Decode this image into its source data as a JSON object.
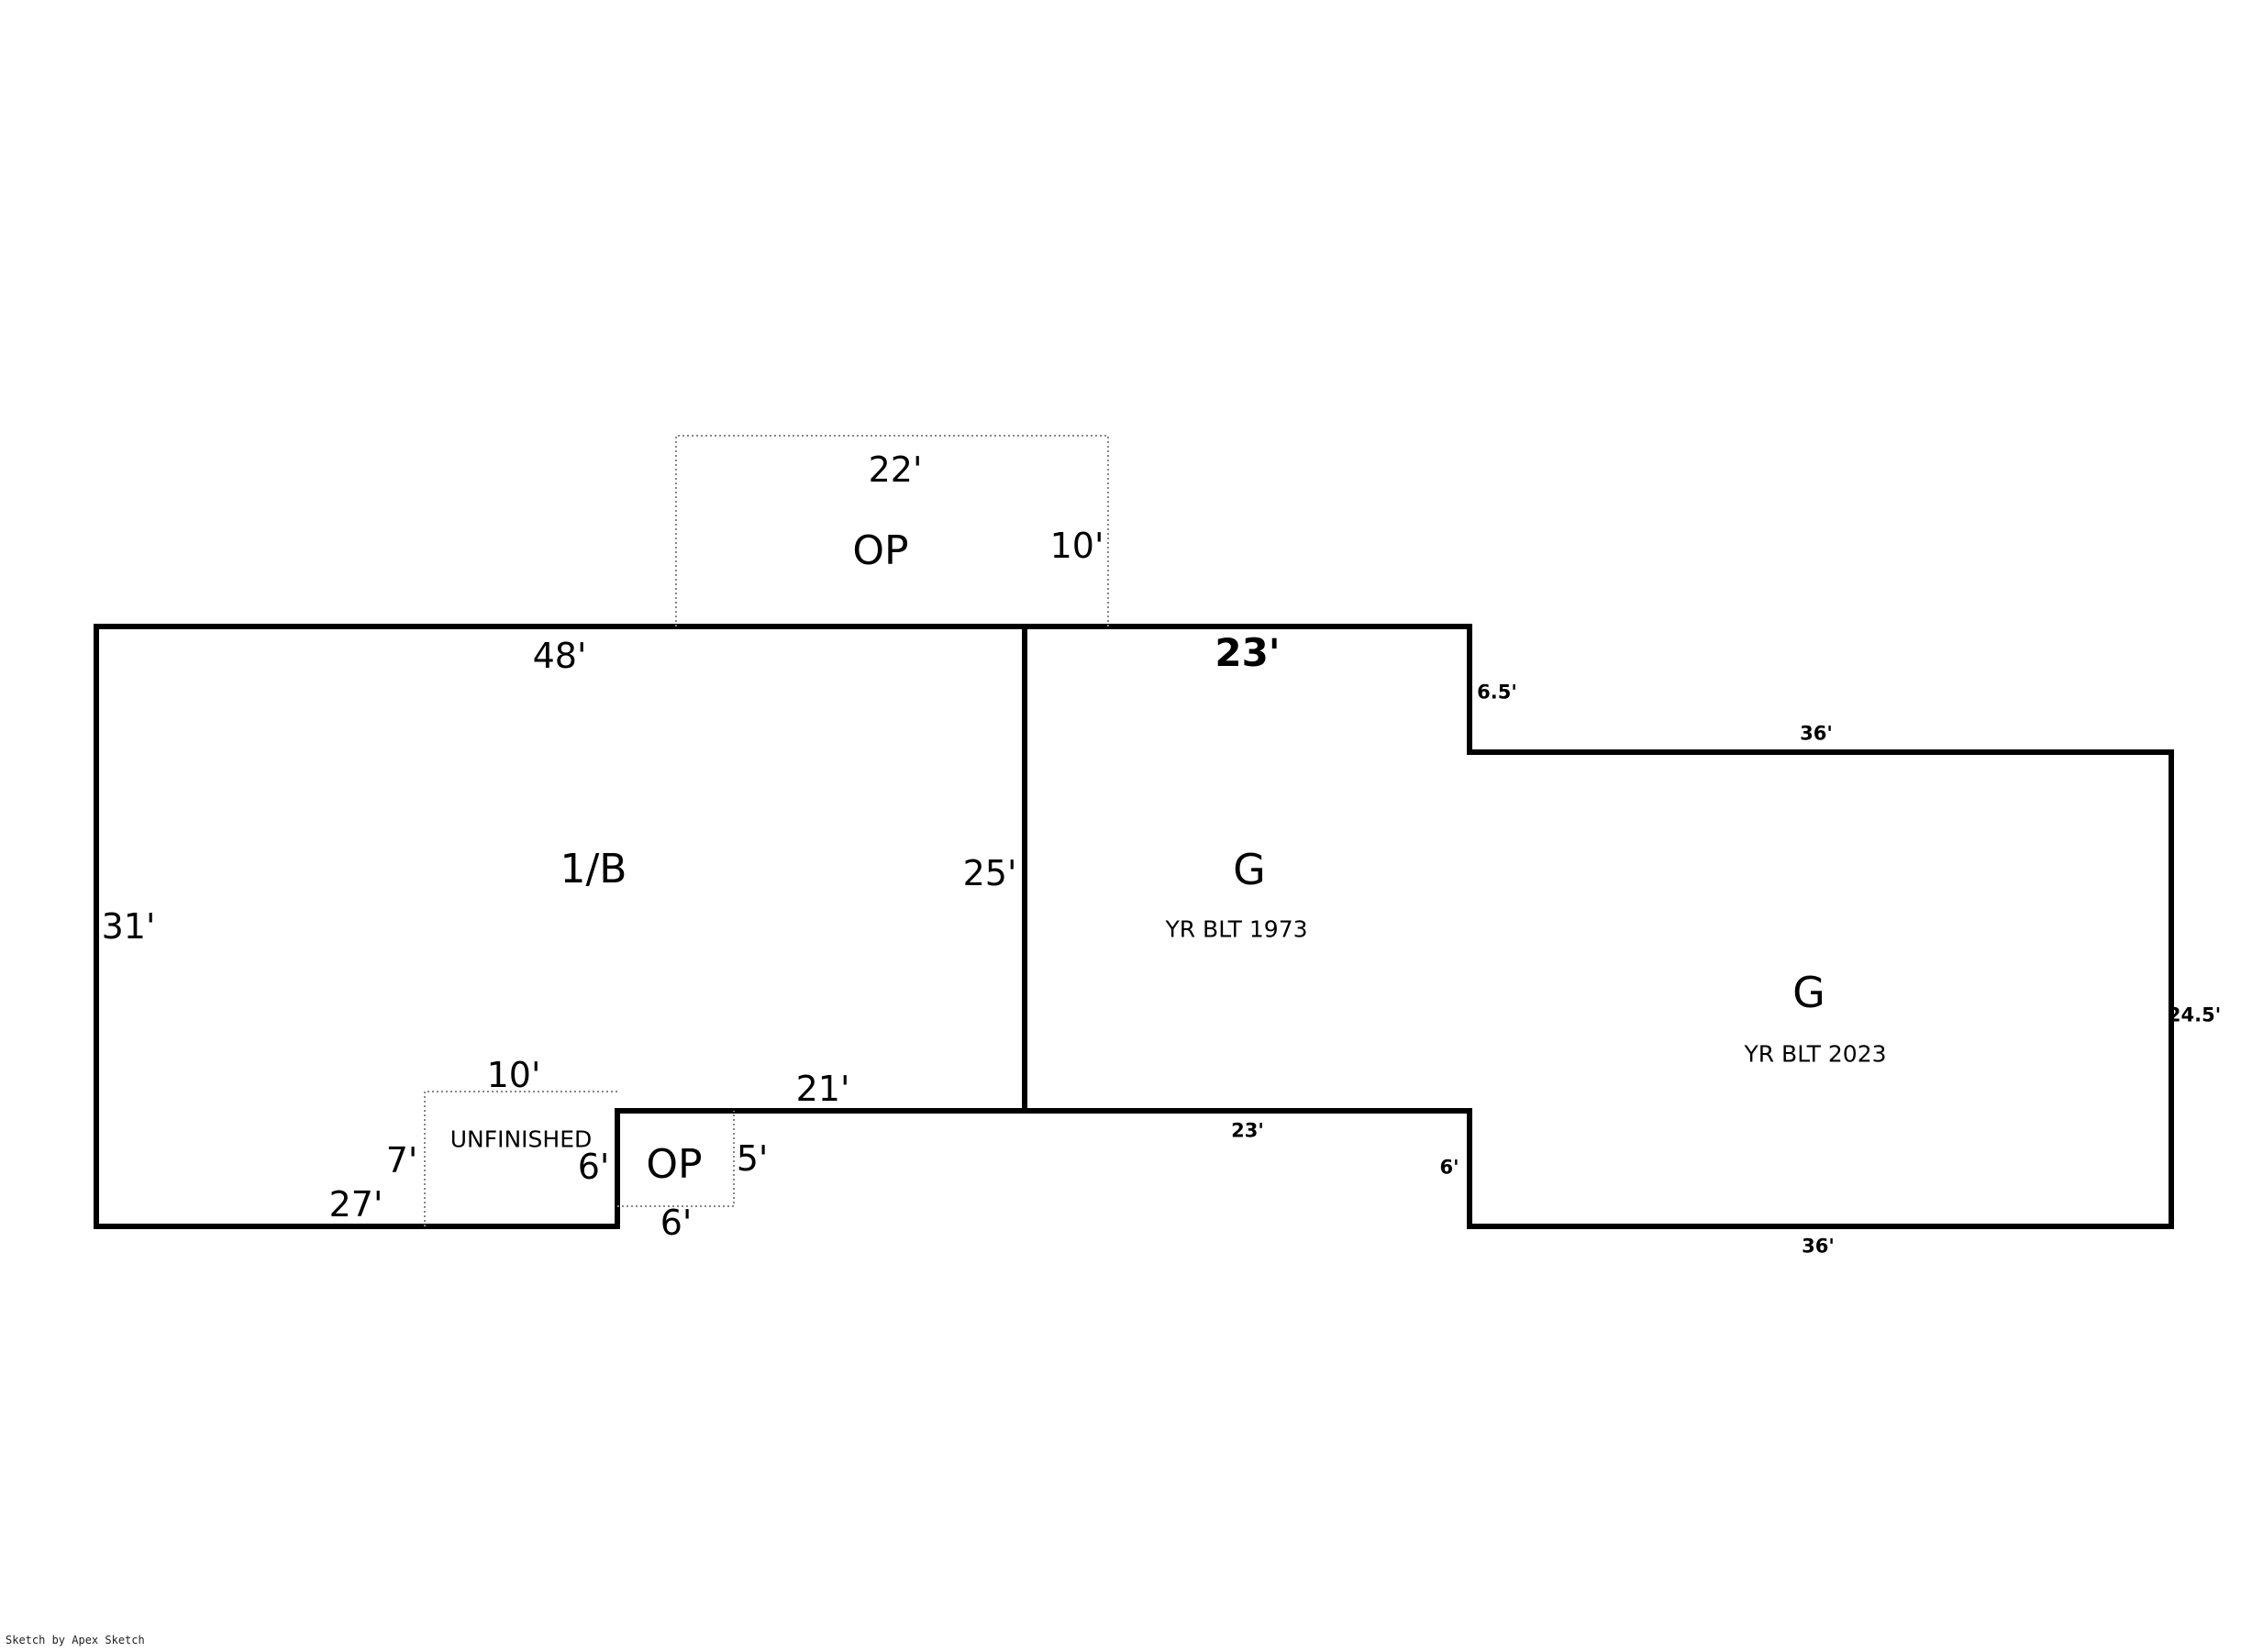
{
  "page": {
    "background": "#ffffff",
    "wall_color": "#000000",
    "dashed_color": "#888888",
    "text_color": "#000000"
  },
  "footer": {
    "credit": "Sketch by Apex Sketch"
  },
  "areas": {
    "porch_top": {
      "label": "OP",
      "width_dim": "22'",
      "depth_dim": "10'"
    },
    "main_house": {
      "label": "1/B",
      "top_dim": "48'",
      "left_dim": "31'",
      "right_dim": "25'",
      "bottom_dim": "27'",
      "notch_top_dim": "21'"
    },
    "garage_1973": {
      "label": "G",
      "year_built": "YR BLT 1973",
      "top_dim": "23'",
      "right_dim": "6.5'",
      "bottom_dim": "23'",
      "step_dim": "6'"
    },
    "garage_2023": {
      "label": "G",
      "year_built": "YR BLT 2023",
      "top_dim": "36'",
      "right_dim": "24.5'",
      "bottom_dim": "36'"
    },
    "unfinished": {
      "label": "UNFINISHED",
      "top_dim": "10'",
      "left_dim": "7'",
      "right_dim": "6'"
    },
    "porch_bottom": {
      "label": "OP",
      "right_dim": "5'",
      "bottom_dim": "6'"
    }
  }
}
